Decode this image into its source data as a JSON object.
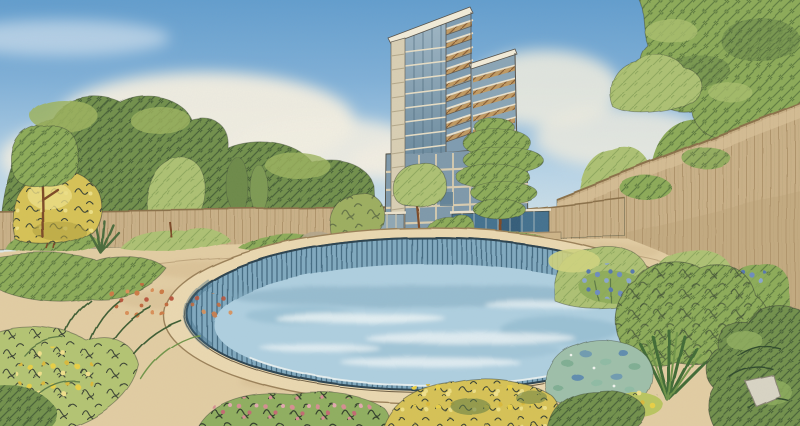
{
  "scene": {
    "type": "watercolor-ink-architectural-rendering",
    "description": "Hand-drawn watercolor and ink rendering of a landscaped residential garden: an oval swimming pool with sandy stone coping in the foreground surrounded by lush planting beds with yellow, pink, orange and blue flowers; tan perimeter garden walls; ornamental trees; a modern stepped high-rise apartment tower with glass facades and timber balconies in the background under a partly cloudy blue watercolor sky",
    "elements": [
      "sky",
      "clouds",
      "background-trees",
      "apartment-tower",
      "tower-balconies",
      "glass-podium",
      "glass-pavilions",
      "garden-wall-left",
      "garden-wall-right",
      "overhanging-tree",
      "garden-steps",
      "sand-deck",
      "oval-pool",
      "pool-coping",
      "pool-wall",
      "pool-water",
      "yellow-shrub",
      "pine-tree",
      "planting-beds",
      "flower-clusters",
      "blue-leaf-groundcover",
      "stone"
    ]
  },
  "palette": {
    "paper": "#f4efe1",
    "sky_top": "#5e9bcd",
    "sky_horizon": "#e6ede9",
    "cloud": "#f3efe2",
    "foliage_dark": "#71904c",
    "foliage_mid": "#8cab58",
    "foliage_light": "#adc173",
    "foliage_yellow": "#d6c255",
    "trunk": "#7b4a28",
    "wall_tan": "#c9b087",
    "sand": "#e2cda3",
    "pool_coping": "#ead8b0",
    "pool_wall": "#7fa9bf",
    "pool_water": "#aecfe0",
    "glass_blue": "#7e99ab",
    "glass_dark": "#43718f",
    "frame_cream": "#e8dec5",
    "wood_balcony": "#c09a62",
    "tower_pier": "#d9cfb4",
    "flower_yellow": "#e8cf45",
    "flower_pink": "#d68d92",
    "flower_orange": "#cc7a45",
    "flower_blue": "#6d8cbe",
    "ink": "#3c4434"
  }
}
